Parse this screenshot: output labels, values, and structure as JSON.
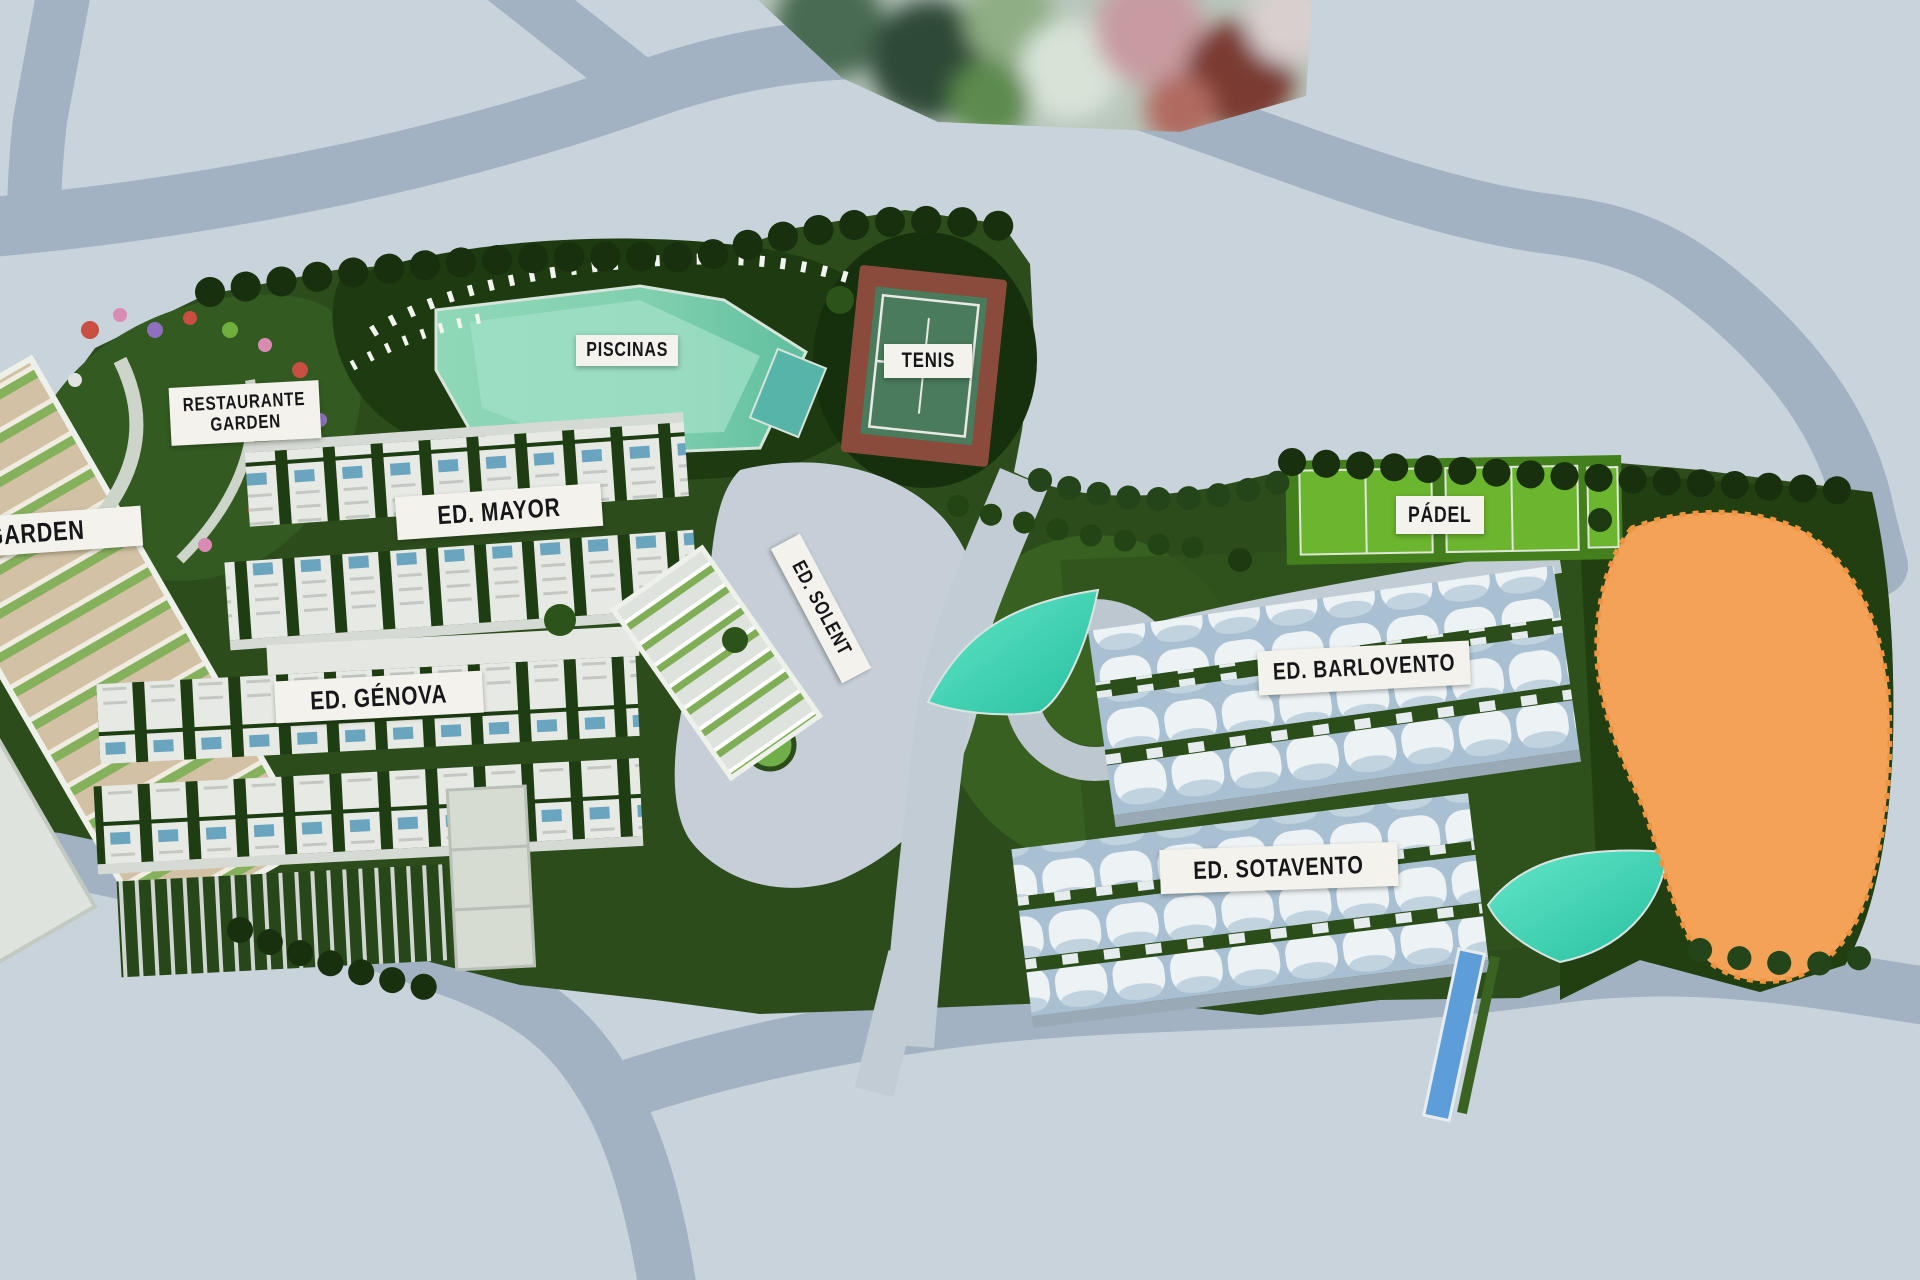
{
  "view": {
    "type": "aerial-site-plan-render",
    "description": "Top-down 3D render of a residential resort masterplan with labelled buildings and amenities"
  },
  "labels": {
    "garden": {
      "text": "GARDEN"
    },
    "restaurante": {
      "line1": "RESTAURANTE",
      "line2": "GARDEN"
    },
    "piscinas": {
      "text": "PISCINAS"
    },
    "tenis": {
      "text": "TENIS"
    },
    "mayor": {
      "text": "ED. MAYOR"
    },
    "solent": {
      "text": "ED. SOLENT"
    },
    "genova": {
      "text": "ED. GÉNOVA"
    },
    "padel": {
      "text": "PÁDEL"
    },
    "barlovento": {
      "text": "ED. BARLOVENTO"
    },
    "sotavento": {
      "text": "ED. SOTAVENTO"
    }
  },
  "theme": {
    "bg": "#c9d3dc",
    "road": "#a2b2c2",
    "path-light": "#c6cfd7",
    "site-green": "#2c4c1c",
    "tree-dark": "#18300e",
    "lawn": "#3a6322",
    "padel-green": "#6cb52e",
    "pool-green": "#84d1b0",
    "pool-teal": "#3ed0b2",
    "tennis-clay": "#8a4b3c",
    "tennis-court": "#4a7b5c",
    "building-white": "#e7eae5",
    "tower-tan": "#d2c1a4",
    "roof-shadow": "#a9bfd2",
    "highlight-orange": "#f3a258",
    "label-bg": "#f3f2ec",
    "label-fg": "#17171a"
  }
}
